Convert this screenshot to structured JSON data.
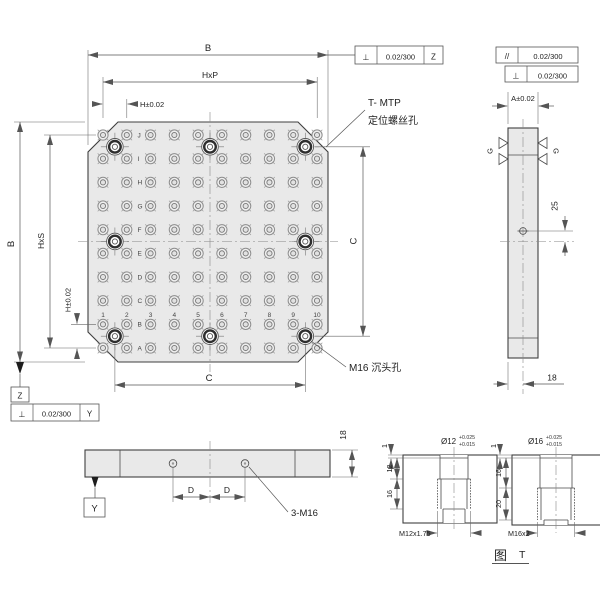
{
  "main_view": {
    "dim_width_top": "B",
    "dim_hxp": "HxP",
    "dim_h_top": "H±0.02",
    "dim_height_left": "B",
    "dim_hxs": "HxS",
    "dim_h_left": "H±0.02",
    "dim_c_right": "C",
    "dim_c_bottom": "C",
    "row_labels": [
      "J",
      "I",
      "H",
      "G",
      "F",
      "E",
      "D",
      "C",
      "B",
      "A"
    ],
    "col_labels": [
      "1",
      "2",
      "3",
      "4",
      "5",
      "6",
      "7",
      "8",
      "9",
      "10"
    ],
    "fcf_top": {
      "sym": "⊥",
      "tol": "0.02/300",
      "datum": "Z"
    },
    "datum_z": "Z",
    "fcf_bottom": {
      "sym": "⊥",
      "tol": "0.02/300",
      "datum": "Y"
    },
    "note_mtp_line1": "T- MTP",
    "note_mtp_line2": "定位螺丝孔",
    "note_m16": "M16 沉头孔"
  },
  "side_view": {
    "fcf_parallel": {
      "sym": "//",
      "tol": "0.02/300"
    },
    "fcf_perp": {
      "sym": "⊥",
      "tol": "0.02/300"
    },
    "dim_a": "A±0.02",
    "dim_25": "25",
    "dim_18": "18",
    "finish_g_left": "G",
    "finish_g_right": "G"
  },
  "front_view": {
    "dim_d_left": "D",
    "dim_d_right": "D",
    "note_3m16": "3-M16",
    "dim_18": "18",
    "datum_y": "Y"
  },
  "detail_views": {
    "m12": {
      "dia": "Ø12",
      "tol_up": "+0.025",
      "tol_low": "+0.015",
      "dim_lip": "1",
      "dim_bore_depth": "12",
      "dim_thread_depth": "16",
      "thread": "M12x1.75"
    },
    "m16": {
      "dia": "Ø16",
      "tol_up": "+0.025",
      "tol_low": "+0.015",
      "dim_lip": "1",
      "dim_bore_depth": "16",
      "dim_thread_depth": "20",
      "thread": "M16x2"
    },
    "caption_fig": "图",
    "caption_ref": "T"
  }
}
